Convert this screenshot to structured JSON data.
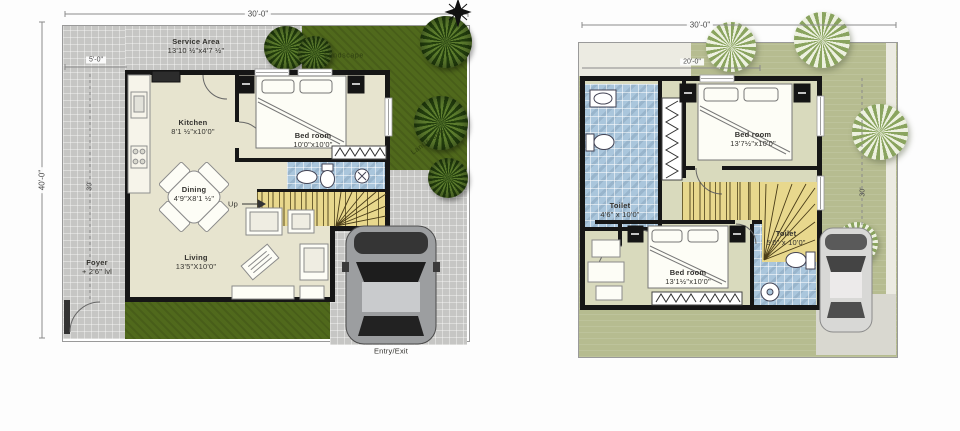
{
  "canvas": {
    "width": 960,
    "height": 431,
    "background": "#ffffff"
  },
  "colors": {
    "wall": "#161616",
    "concrete": "#c6c6c4",
    "landscape_dark": "#50691c",
    "landscape_sage": "#b6bc90",
    "toilet_blue": "#aac6dc",
    "stairs_yellow": "#e8d88d",
    "room_beige": "#e7e4cf",
    "room_sage": "#d9dabd"
  },
  "ground_floor": {
    "dims": {
      "top": "30'-0\"",
      "left": "40'-0\"",
      "inner_left": "30'",
      "service": "5'-0\""
    },
    "rooms": {
      "service": {
        "label": "Service Area",
        "size": "13'10 ½\"x4'7 ½\""
      },
      "kitchen": {
        "label": "Kitchen",
        "size": "8'1 ½\"x10'0\""
      },
      "bedroom": {
        "label": "Bed room",
        "size": "10'0\"x10'0\""
      },
      "dining": {
        "label": "Dining",
        "size": "4'9\"X8'1 ½\""
      },
      "living": {
        "label": "Living",
        "size": "13'5\"X10'0\""
      },
      "foyer": {
        "label": "Foyer",
        "size": "+ 2'6\" lvl"
      }
    },
    "annotations": {
      "up": "Up",
      "entry_exit": "Entry/Exit",
      "landscape_top": "Landscape",
      "landscape_side": "Landscape"
    }
  },
  "first_floor": {
    "dims": {
      "top": "30'-0\"",
      "inner": "20'-0\"",
      "right": "30'"
    },
    "rooms": {
      "toilet_top": {
        "label": "Toilet",
        "size": "4'6\" x 10'0\""
      },
      "bedroom_top": {
        "label": "Bed room",
        "size": "13'7½\"x10'0\""
      },
      "bedroom_bottom": {
        "label": "Bed room",
        "size": "13'1½\"x10'0\""
      },
      "toilet_bottom": {
        "label": "Toilet",
        "size": "5'0\" x 10'0\""
      }
    }
  }
}
